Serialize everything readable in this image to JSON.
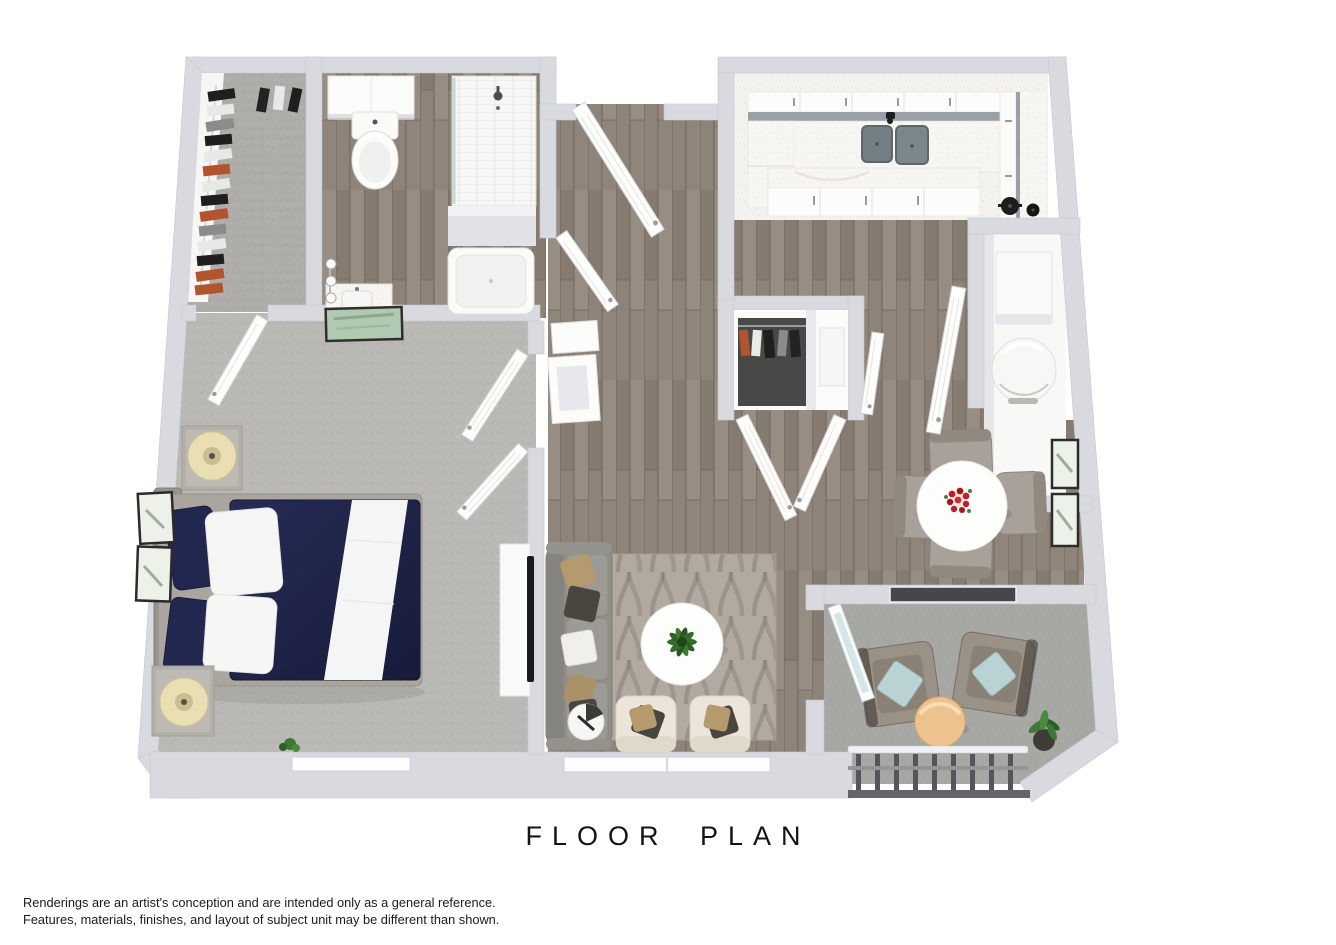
{
  "title": "FLOOR PLAN",
  "disclaimer": {
    "line1": "Renderings are an artist's conception and are intended only as a general reference.",
    "line2": "Features, materials, finishes, and layout of subject unit may be different than shown."
  },
  "rooms": [
    "walk-in-closet",
    "bathroom",
    "entry-hall",
    "kitchen",
    "coat-closet",
    "utility-closet",
    "bedroom",
    "living-room",
    "dining-area",
    "balcony"
  ],
  "palette": {
    "wall": "#d9dae0",
    "wall_edge": "#c6c7cf",
    "wood_floor": "#8e8378",
    "carpet": "#bab9b6",
    "closet_carpet": "#aeadaa",
    "concrete": "#a7a7a4",
    "kitchen_floor": "#f3f2ee",
    "counter_speckle": "#f7f6f2",
    "counter_edge": "#99a0a8",
    "sink_gray": "#747e85",
    "duvet_navy": "#20244a",
    "sofa_gray": "#92918c",
    "rug_base": "#b2aaa1",
    "accent_chair_cream": "#ece6da",
    "pillow_tan": "#b59a6d",
    "pillow_brown": "#4b453f",
    "pillow_blue": "#b9d3d5",
    "patio_chair_taupe": "#9b9287",
    "ottoman_tan": "#edc28e",
    "flower_red": "#bf1f26",
    "plant_green": "#3c7a33",
    "railing_dark": "#54565b",
    "clothes_rust": "#b2552e",
    "tv_black": "#1b1b1d",
    "glass_blue": "#cfe3e6"
  }
}
